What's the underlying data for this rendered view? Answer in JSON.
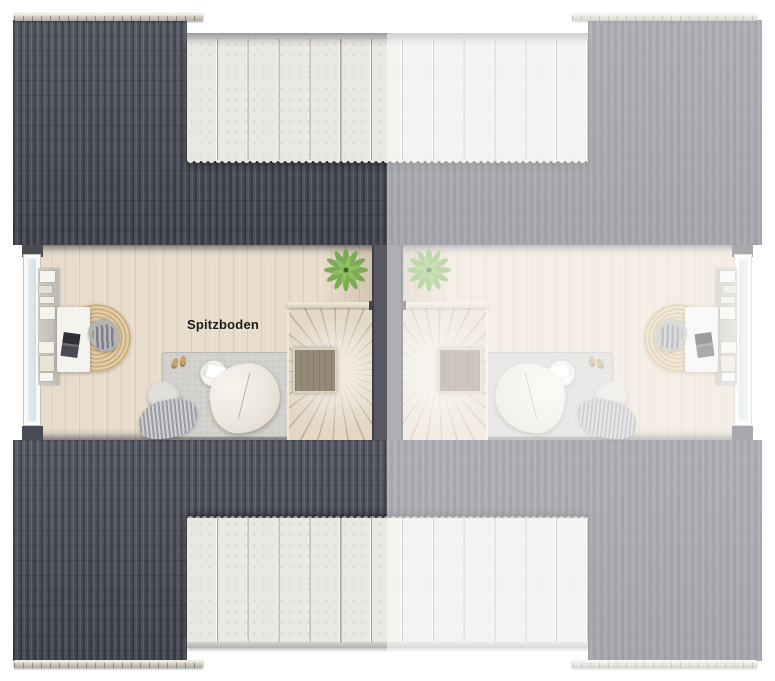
{
  "plan": {
    "room_label": "Spitzboden",
    "left_unit": "full-color unit",
    "right_unit": "faded mirrored unit"
  },
  "palette": {
    "roof_dark": "#4c4e59",
    "ridge_cap": "#d8d3c7",
    "dormer_panel": "#eae8e3",
    "floor_wood": "#e8dccb",
    "party_wall": "#575861",
    "stair_tread": "#e3d8c6",
    "stair_void": "#95897a",
    "area_rug": "#d3d2cf",
    "jute_rug": "#dcc49c",
    "beanbag": "#ece7dd",
    "plant_green": "#7cab55",
    "label_color": "#1d1d1f",
    "fade_overlay": "rgba(255,255,255,0.52)"
  }
}
